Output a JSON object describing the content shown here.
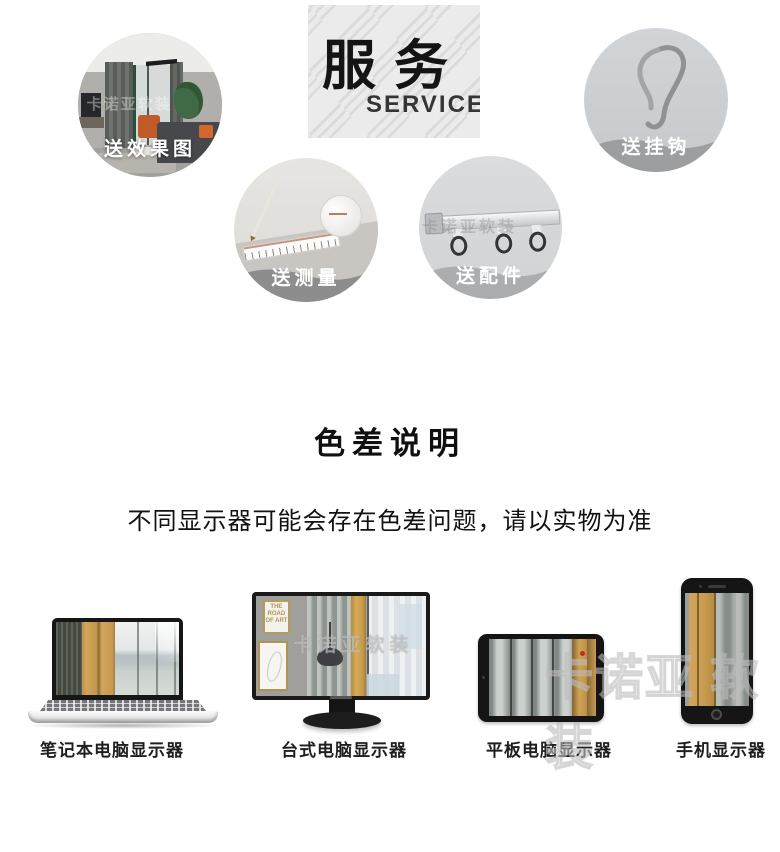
{
  "services": {
    "title": "服务",
    "subtitle": "SERVICE",
    "items": [
      {
        "id": "effect",
        "label": "送效果图",
        "image": "living-room-render-photo"
      },
      {
        "id": "hook",
        "label": "送挂钩",
        "image": "curtain-hook-photo"
      },
      {
        "id": "measure",
        "label": "送测量",
        "image": "measuring-tape-photo"
      },
      {
        "id": "track",
        "label": "送配件",
        "image": "curtain-track-photo"
      }
    ]
  },
  "color_note": {
    "heading": "色差说明",
    "description": "不同显示器可能会存在色差问题，请以实物为准"
  },
  "devices": {
    "items": [
      {
        "id": "laptop",
        "label": "笔记本电脑显示器"
      },
      {
        "id": "desktop",
        "label": "台式电脑显示器"
      },
      {
        "id": "tablet",
        "label": "平板电脑显示器"
      },
      {
        "id": "phone",
        "label": "手机显示器"
      }
    ]
  },
  "watermark": {
    "text": "卡诺亚软装",
    "text_spaced": "卡诺亚 软装"
  },
  "frame_art": {
    "text": "THE ROAD OF ART"
  },
  "colors": {
    "accent_gold": "#c99c52",
    "band_gray_dark": "#8d8d8e",
    "band_gray": "#9c9ea0",
    "band_gray_light": "#abadaf",
    "title_black": "#141414"
  }
}
